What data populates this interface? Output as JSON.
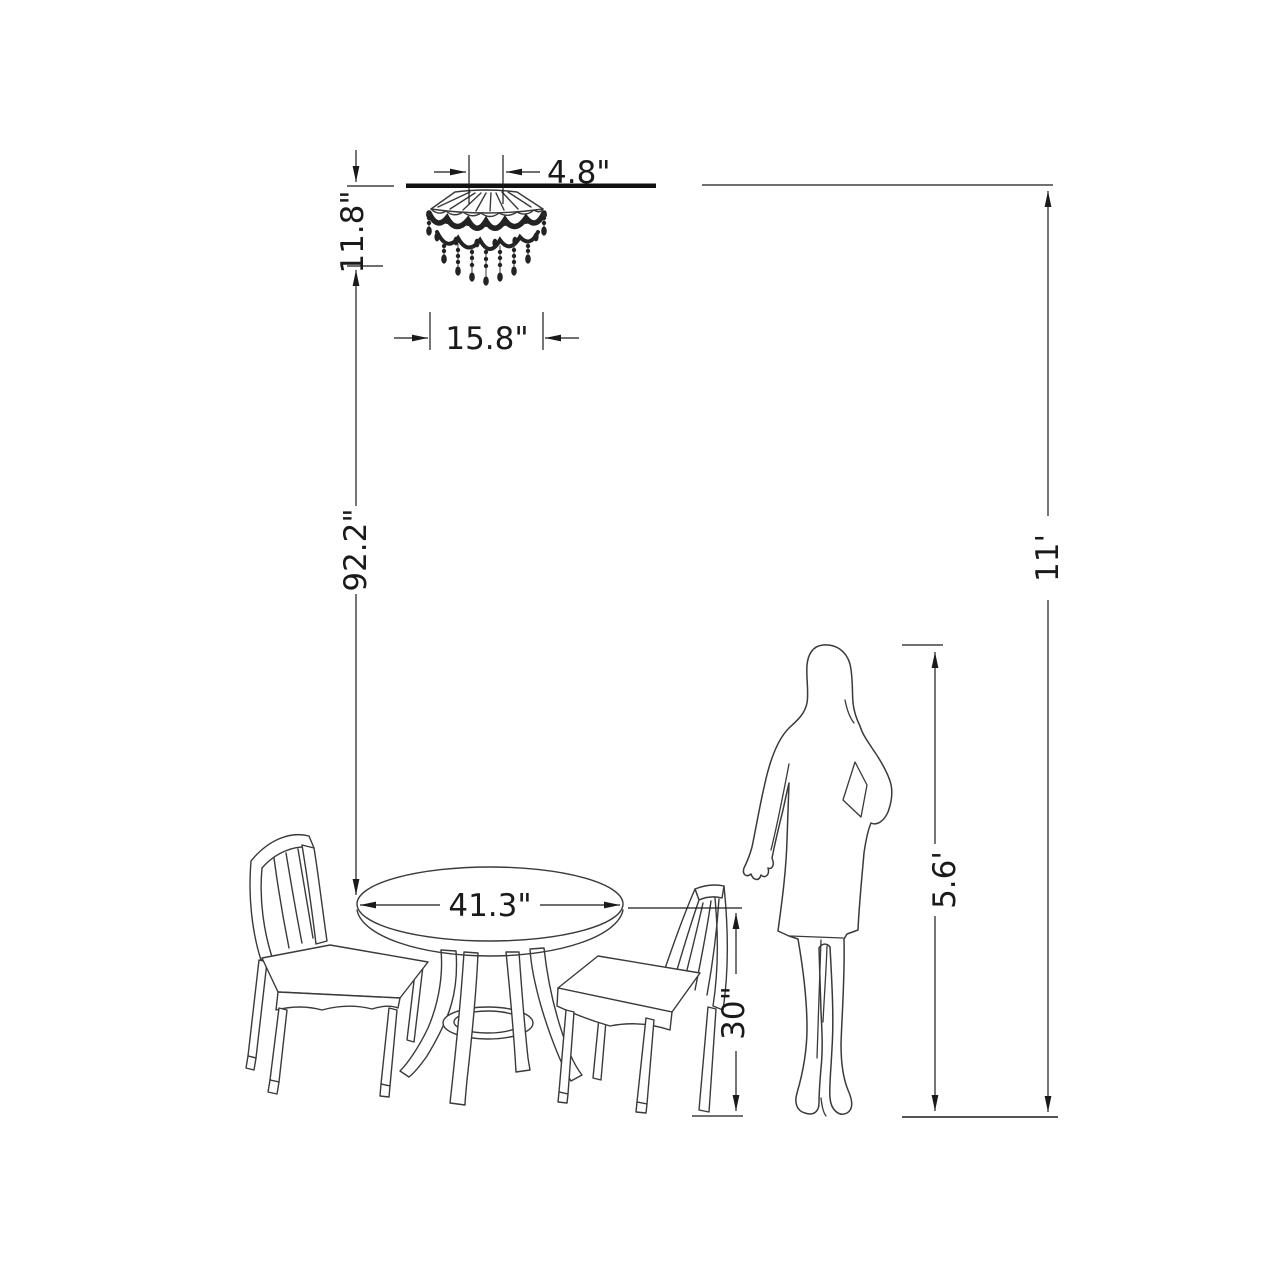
{
  "dimensions": {
    "canopy_width": "4.8\"",
    "fixture_height": "11.8\"",
    "fixture_width": "15.8\"",
    "hanging_height": "92.2\"",
    "ceiling_height": "11'",
    "table_diameter": "41.3\"",
    "table_height": "30\"",
    "person_height": "5.6'"
  },
  "colors": {
    "background": "#ffffff",
    "dimension_line": "#1a1a1a",
    "artwork_line": "#3a3a3a"
  }
}
